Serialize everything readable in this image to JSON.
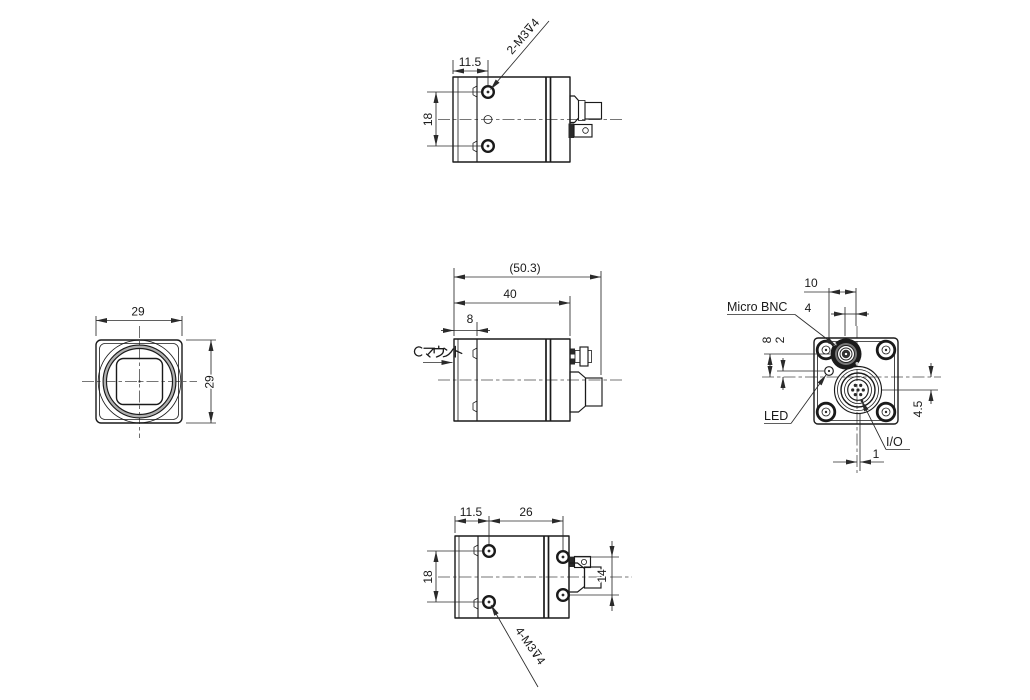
{
  "views": {
    "front": {
      "dims": {
        "width": "29",
        "height": "29"
      }
    },
    "top": {
      "dims": {
        "offset": "11.5",
        "pitch": "18"
      },
      "thread_note": "2-M3⊽4"
    },
    "side": {
      "dims": {
        "overall": "(50.3)",
        "body": "40",
        "front": "8"
      },
      "mount_label": "Cマウント"
    },
    "rear": {
      "dims": {
        "led_to_center": "10",
        "bnc_to_center": "4",
        "bnc_above_center": "8",
        "led_above_center": "2",
        "io_below_center": "4.5",
        "io_off_center": "1"
      },
      "labels": {
        "bnc": "Micro BNC",
        "led": "LED",
        "io": "I/O"
      }
    },
    "bottom": {
      "dims": {
        "offset": "11.5",
        "span": "26",
        "pitch_front": "18",
        "pitch_rear": "14"
      },
      "thread_note": "4-M3⊽4"
    }
  },
  "colors": {
    "line": "#1a1a1a",
    "dim": "#2a2a2a",
    "centerline": "#4a4a4a",
    "background": "#ffffff",
    "shade": "#b0b0b0"
  }
}
